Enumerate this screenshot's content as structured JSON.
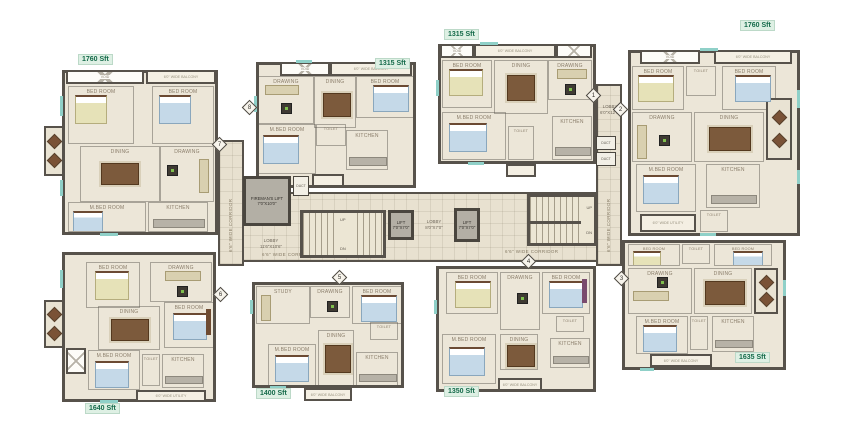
{
  "labels": {
    "corridor": "6'6\" WIDE CORRIDOR",
    "fireman_lift": "FIREMAN'S LIFT",
    "fireman_lift_dim": "7'0\"X10'0\"",
    "lift": "LIFT",
    "lift_dim": "7'0\"X7'0\"",
    "lobby": "LOBBY",
    "lobby_main_dim": "11'6\"X10'6\"",
    "lobby_mid_dim": "8'0\"X7'0\"",
    "lobby_right_dim": "6'0\"X12'0\"",
    "up": "UP",
    "dn": "DN",
    "void": "VOID",
    "duct": "DUCT"
  },
  "rooms": {
    "bed": "BED ROOM",
    "mbed": "M.BED ROOM",
    "dining": "DINING",
    "drawing": "DRAWING",
    "kitchen": "KITCHEN",
    "toilet": "TOILET",
    "study": "STUDY",
    "sitout": "SIT OUT",
    "balcony": "6'0\" WIDE BALCONY",
    "utility": "6'0\" WIDE UTILITY"
  },
  "units": [
    {
      "area": "1760 Sft"
    },
    {
      "area": "1315 Sft"
    },
    {
      "area": "1315 Sft"
    },
    {
      "area": "1760 Sft"
    },
    {
      "area": "1640 Sft"
    },
    {
      "area": "1400 Sft"
    },
    {
      "area": "1350 Sft"
    },
    {
      "area": "1635 Sft"
    }
  ],
  "markers": [
    "1",
    "2",
    "3",
    "4",
    "5",
    "6",
    "7",
    "8"
  ]
}
